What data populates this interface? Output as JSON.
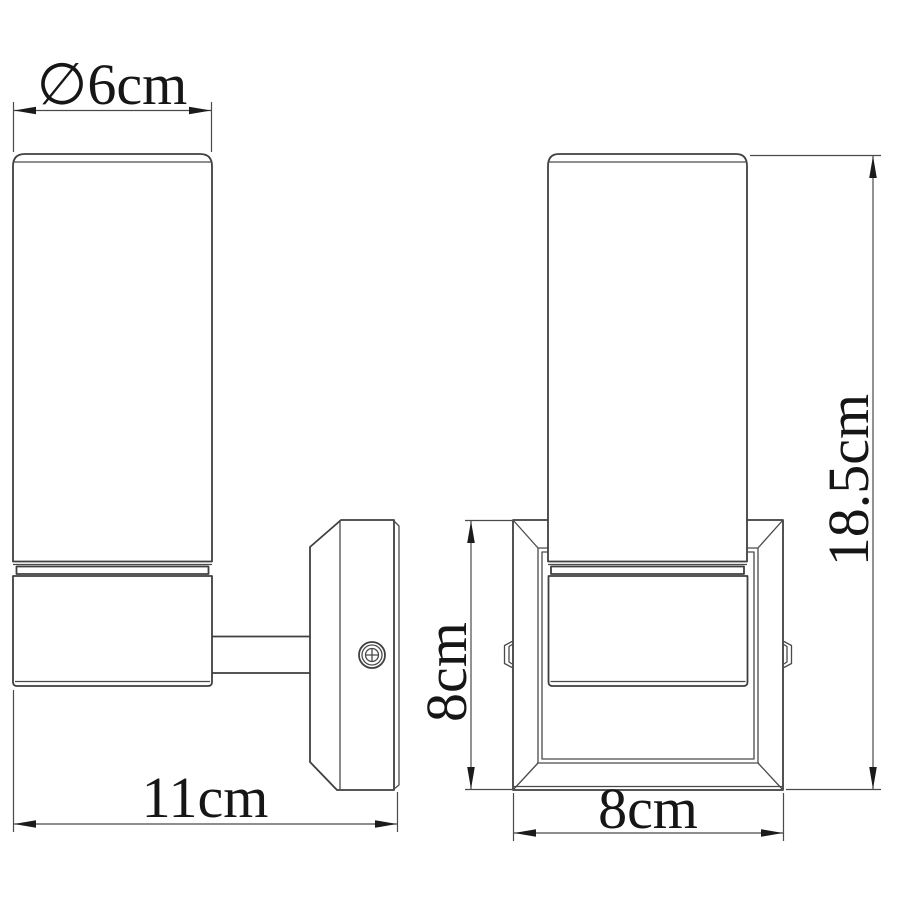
{
  "drawing": {
    "kind": "wall-lamp technical drawing, two orthographic views",
    "background": "#ffffff",
    "colors": {
      "object_line": "#3f3f3f",
      "dimension_line": "#4a4a4a",
      "text": "#161616"
    }
  },
  "dimensions": {
    "diameter": {
      "label": "∅6cm"
    },
    "depth": {
      "label": "11cm"
    },
    "plate_height": {
      "label": "8cm"
    },
    "plate_width": {
      "label": "8cm"
    },
    "total_height": {
      "label": "18.5cm"
    }
  },
  "icons": {
    "screw_head": "phillips-screw-icon",
    "diameter_symbol": "diameter-icon"
  }
}
